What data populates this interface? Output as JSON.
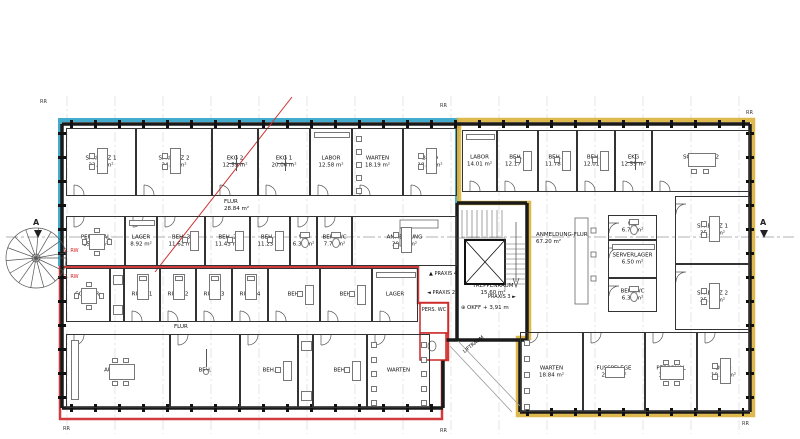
{
  "colors": {
    "praxis1_outline": "#2fa3c7",
    "praxis2_outline": "#cc2626",
    "praxis3_outline": "#d9b13b",
    "wall": "#1a1a1a",
    "section_line": "#999999",
    "red_diagonal": "#cc3333"
  },
  "ann": {
    "treppenraum_name": "TREPPENRAUM",
    "treppenraum_area": "15.60 m²",
    "okff": "OKFF + 3,91 m",
    "liftraum": "LIFTRAUM",
    "praxis2": "PRAXIS 2",
    "praxis3": "PRAXIS 3",
    "praxis4": "PRAXIS 4",
    "pers_wc": "PERS. WC",
    "anmeldung_flur_name": "ANMELDUNG-FLUR",
    "anmeldung_flur_area": "67.20 m²",
    "rw2": "2. RW",
    "section_marker": "A",
    "grid_tick": "RR"
  },
  "rooms": [
    {
      "id": "sprechz1-l",
      "n": "SPRECHZ 1",
      "a": "22.24 m²",
      "x": 66,
      "y": 128,
      "w": 70,
      "h": 68,
      "f": "desk",
      "d": "b"
    },
    {
      "id": "sprechz2-l",
      "n": "SPRECHZ 2",
      "a": "24.87 m²",
      "x": 136,
      "y": 128,
      "w": 76,
      "h": 68,
      "f": "desk",
      "d": "b"
    },
    {
      "id": "ekg2-l",
      "n": "EKG 2",
      "a": "12.59 m²",
      "x": 212,
      "y": 128,
      "w": 46,
      "h": 68,
      "f": "cross",
      "d": "b"
    },
    {
      "id": "ekg1-l",
      "n": "EKG 1",
      "a": "20.06 m²",
      "x": 258,
      "y": 128,
      "w": 52,
      "h": 68,
      "f": "cross",
      "d": "b"
    },
    {
      "id": "labor-l",
      "n": "LABOR",
      "a": "12.58 m²",
      "x": 310,
      "y": 128,
      "w": 42,
      "h": 68,
      "f": "cab",
      "d": "b"
    },
    {
      "id": "warten-l",
      "n": "WARTEN",
      "a": "18.19 m²",
      "x": 352,
      "y": 128,
      "w": 51,
      "h": 68,
      "f": "chairs-left",
      "d": "b"
    },
    {
      "id": "buero-l",
      "n": "BÜRO",
      "a": "18.06 m²",
      "x": 403,
      "y": 128,
      "w": 54,
      "h": 68,
      "f": "desk",
      "d": "b"
    },
    {
      "id": "flur-l",
      "n": "FLUR",
      "a": "28.84 m²",
      "x": 66,
      "y": 196,
      "w": 391,
      "h": 20,
      "open": true,
      "lx": 158,
      "ly": 3
    },
    {
      "id": "personal-l",
      "n": "PERSONAL",
      "a": "15.71 m²",
      "x": 66,
      "y": 216,
      "w": 59,
      "h": 50,
      "f": "table4",
      "d": "t"
    },
    {
      "id": "lager-l",
      "n": "LAGER",
      "a": "8.92 m²",
      "x": 125,
      "y": 216,
      "w": 32,
      "h": 50,
      "f": "cab",
      "d": "t"
    },
    {
      "id": "beh3-l",
      "n": "BEH. 3",
      "a": "11.62 m²",
      "x": 157,
      "y": 216,
      "w": 48,
      "h": 50,
      "f": "deskS",
      "d": "t"
    },
    {
      "id": "beh2-l",
      "n": "BEH. 2",
      "a": "11.43 m²",
      "x": 205,
      "y": 216,
      "w": 45,
      "h": 50,
      "f": "deskS",
      "d": "t"
    },
    {
      "id": "beh1-l",
      "n": "BEH. 1",
      "a": "11.23 m²",
      "x": 250,
      "y": 216,
      "w": 40,
      "h": 50,
      "f": "deskS",
      "d": "t"
    },
    {
      "id": "wc-l",
      "n": "WC",
      "a": "6.32 m²",
      "x": 290,
      "y": 216,
      "w": 27,
      "h": 50,
      "f": "wc",
      "d": "t"
    },
    {
      "id": "behwc-l",
      "n": "BEH. WC",
      "a": "7.78 m²",
      "x": 317,
      "y": 216,
      "w": 35,
      "h": 50,
      "f": "wc",
      "d": "t"
    },
    {
      "id": "anmeldung-l",
      "n": "ANMELDUNG",
      "a": "30.92 m²",
      "x": 352,
      "y": 216,
      "w": 105,
      "h": 50,
      "f": "desk"
    },
    {
      "id": "sozialr",
      "n": "SOZIALR.",
      "a": "",
      "x": 66,
      "y": 268,
      "w": 44,
      "h": 54,
      "f": "table4"
    },
    {
      "id": "shaft-a",
      "n": "",
      "a": "",
      "x": 110,
      "y": 268,
      "w": 14,
      "h": 54,
      "f": "cab2"
    },
    {
      "id": "ruhe1",
      "n": "RUHE 1",
      "a": "",
      "x": 124,
      "y": 268,
      "w": 36,
      "h": 54,
      "f": "bed",
      "d": "b"
    },
    {
      "id": "ruhe2",
      "n": "RUHE 2",
      "a": "",
      "x": 160,
      "y": 268,
      "w": 36,
      "h": 54,
      "f": "bed",
      "d": "b"
    },
    {
      "id": "ruhe3",
      "n": "RUHE 3",
      "a": "",
      "x": 196,
      "y": 268,
      "w": 36,
      "h": 54,
      "f": "bed",
      "d": "b"
    },
    {
      "id": "ruhe4",
      "n": "RUHE 4",
      "a": "",
      "x": 232,
      "y": 268,
      "w": 36,
      "h": 54,
      "f": "bed",
      "d": "b"
    },
    {
      "id": "beh-a1",
      "n": "BEH.",
      "a": "",
      "x": 268,
      "y": 268,
      "w": 52,
      "h": 54,
      "f": "deskS",
      "d": "b"
    },
    {
      "id": "beh-a2",
      "n": "BEH.",
      "a": "",
      "x": 320,
      "y": 268,
      "w": 52,
      "h": 54,
      "f": "deskS",
      "d": "b"
    },
    {
      "id": "lager-a",
      "n": "LAGER",
      "a": "",
      "x": 372,
      "y": 268,
      "w": 46,
      "h": 54,
      "f": "cab",
      "d": "b"
    },
    {
      "id": "flur-a",
      "n": "FLUR",
      "a": "",
      "x": 66,
      "y": 322,
      "w": 352,
      "h": 12,
      "open": true,
      "lx": 108,
      "ly": 2
    },
    {
      "id": "aufenth",
      "n": "AUFENTH.",
      "a": "",
      "x": 66,
      "y": 334,
      "w": 104,
      "h": 74,
      "f": "table6kit",
      "d": "t"
    },
    {
      "id": "beh-b1",
      "n": "BEH.",
      "a": "",
      "x": 170,
      "y": 334,
      "w": 70,
      "h": 74,
      "f": "scale",
      "d": "t"
    },
    {
      "id": "beh-b2",
      "n": "BEH.",
      "a": "",
      "x": 240,
      "y": 334,
      "w": 58,
      "h": 74,
      "f": "deskS",
      "d": "t"
    },
    {
      "id": "shaft-b",
      "n": "",
      "a": "",
      "x": 298,
      "y": 334,
      "w": 15,
      "h": 74,
      "f": "cab2"
    },
    {
      "id": "beh-b3",
      "n": "BEH.",
      "a": "",
      "x": 313,
      "y": 334,
      "w": 54,
      "h": 74,
      "f": "deskS",
      "d": "t"
    },
    {
      "id": "warten-b",
      "n": "WARTEN",
      "a": "",
      "x": 367,
      "y": 334,
      "w": 63,
      "h": 74,
      "f": "chairs-both",
      "d": "t"
    },
    {
      "id": "labor-r",
      "n": "LABOR",
      "a": "14.01 m²",
      "x": 462,
      "y": 130,
      "w": 35,
      "h": 62,
      "f": "cab",
      "d": "b"
    },
    {
      "id": "beh1-r",
      "n": "BEH.1",
      "a": "12.17 m²",
      "x": 497,
      "y": 130,
      "w": 41,
      "h": 62,
      "f": "deskS",
      "d": "b"
    },
    {
      "id": "beh2-r",
      "n": "BEH. 2",
      "a": "11.78 m²",
      "x": 538,
      "y": 130,
      "w": 39,
      "h": 62,
      "f": "deskS",
      "d": "b"
    },
    {
      "id": "beh3-r",
      "n": "BEH. 3",
      "a": "12.01 m²",
      "x": 577,
      "y": 130,
      "w": 38,
      "h": 62,
      "f": "deskS",
      "d": "b"
    },
    {
      "id": "ekg-r",
      "n": "EKG",
      "a": "12.59 m²",
      "x": 615,
      "y": 130,
      "w": 37,
      "h": 62,
      "f": "cross",
      "d": "b"
    },
    {
      "id": "schulung2",
      "n": "SCHULUNG 2",
      "a": "34.39 m²",
      "x": 652,
      "y": 130,
      "w": 98,
      "h": 62,
      "f": "tableL",
      "d": "b"
    },
    {
      "id": "wc-r",
      "n": "WC",
      "a": "6.76 m²",
      "x": 608,
      "y": 215,
      "w": 49,
      "h": 25,
      "f": "wc",
      "d": "l"
    },
    {
      "id": "server-r",
      "n": "SERVERLAGER",
      "a": "6.50 m²",
      "x": 608,
      "y": 240,
      "w": 49,
      "h": 38,
      "f": "cab",
      "d": "l"
    },
    {
      "id": "behwc-r",
      "n": "BEH. WC",
      "a": "6.36 m²",
      "x": 608,
      "y": 278,
      "w": 49,
      "h": 34,
      "f": "wc",
      "d": "l"
    },
    {
      "id": "sprechz1-r",
      "n": "SPRECHZ 1",
      "a": "25.90 m²",
      "x": 675,
      "y": 196,
      "w": 75,
      "h": 68,
      "f": "desk",
      "d": "l"
    },
    {
      "id": "sprechz2-r",
      "n": "SPRECHZ 2",
      "a": "25.90 m²",
      "x": 675,
      "y": 264,
      "w": 75,
      "h": 66,
      "f": "desk",
      "d": "l"
    },
    {
      "id": "warten-r",
      "n": "WARTEN",
      "a": "18.84 m²",
      "x": 520,
      "y": 332,
      "w": 63,
      "h": 80,
      "f": "chairs-left",
      "d": "t"
    },
    {
      "id": "fusspflege",
      "n": "FUSSPFLEGE",
      "a": "21.91 m²",
      "x": 583,
      "y": 332,
      "w": 62,
      "h": 80,
      "f": "couch",
      "d": "t"
    },
    {
      "id": "personal-r",
      "n": "PERSONAL",
      "a": "17.80 m²",
      "x": 645,
      "y": 332,
      "w": 52,
      "h": 80,
      "f": "table6",
      "d": "t"
    },
    {
      "id": "buero-r",
      "n": "BÜRO",
      "a": "19.35 m²",
      "x": 697,
      "y": 332,
      "w": 53,
      "h": 80,
      "f": "desk",
      "d": "t"
    }
  ]
}
